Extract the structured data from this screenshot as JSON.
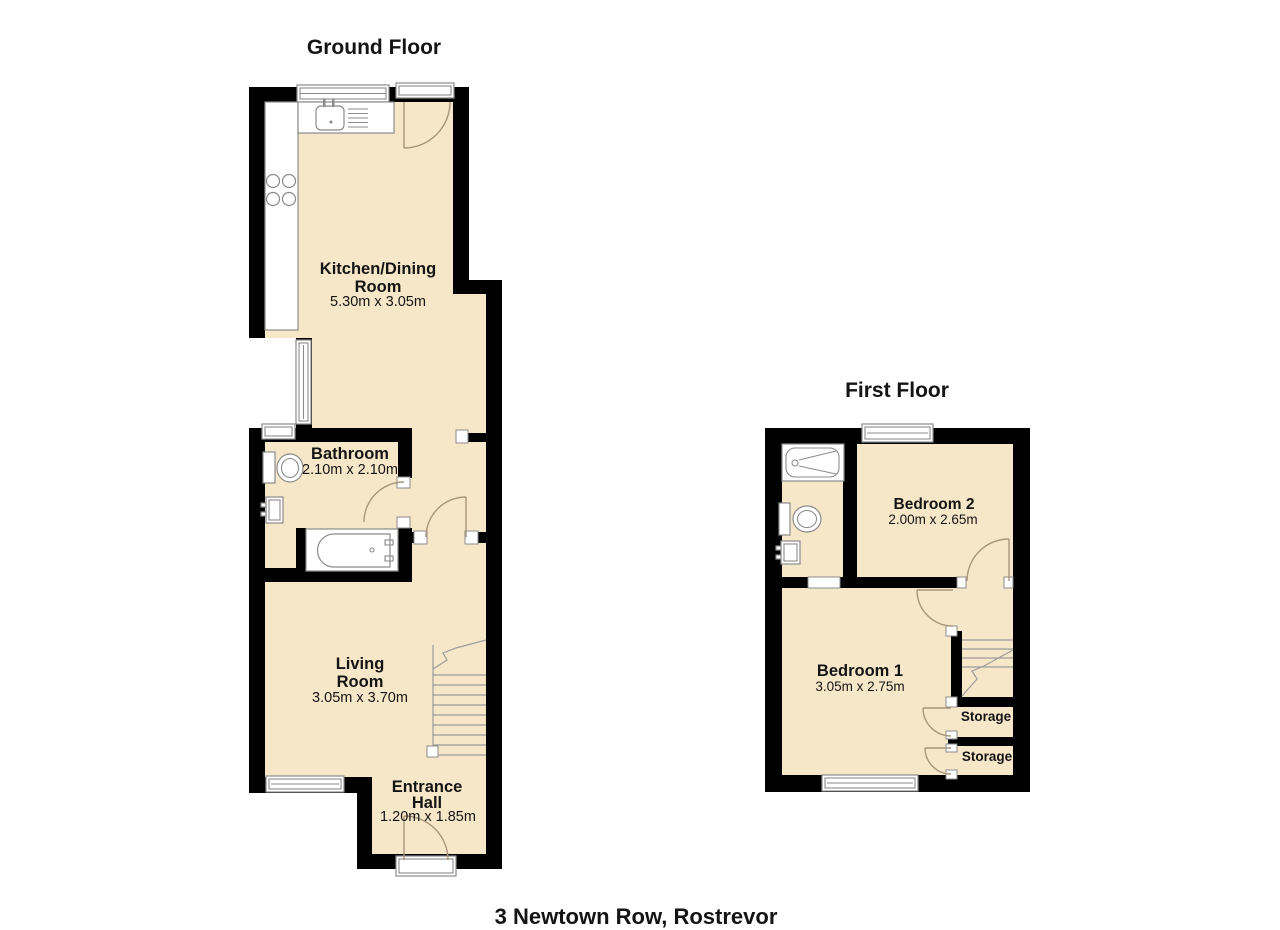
{
  "page": {
    "address": "3 Newtown Row, Rostrevor"
  },
  "colors": {
    "floor_fill": "#F7E7C9",
    "wall": "#000000",
    "fixture_stroke": "#8B8B8B",
    "door_arc": "#A8957B"
  },
  "ground_floor": {
    "title": "Ground Floor",
    "rooms": {
      "kitchen": {
        "name_line1": "Kitchen/Dining",
        "name_line2": "Room",
        "dims": "5.30m x 3.05m"
      },
      "bathroom": {
        "name": "Bathroom",
        "dims": "2.10m x 2.10m"
      },
      "living": {
        "name_line1": "Living",
        "name_line2": "Room",
        "dims": "3.05m x 3.70m"
      },
      "hall": {
        "name_line1": "Entrance",
        "name_line2": "Hall",
        "dims": "1.20m x 1.85m"
      }
    }
  },
  "first_floor": {
    "title": "First Floor",
    "rooms": {
      "bedroom2": {
        "name": "Bedroom 2",
        "dims": "2.00m x 2.65m"
      },
      "bedroom1": {
        "name": "Bedroom 1",
        "dims": "3.05m x 2.75m"
      },
      "storage1": {
        "name": "Storage"
      },
      "storage2": {
        "name": "Storage"
      }
    }
  }
}
